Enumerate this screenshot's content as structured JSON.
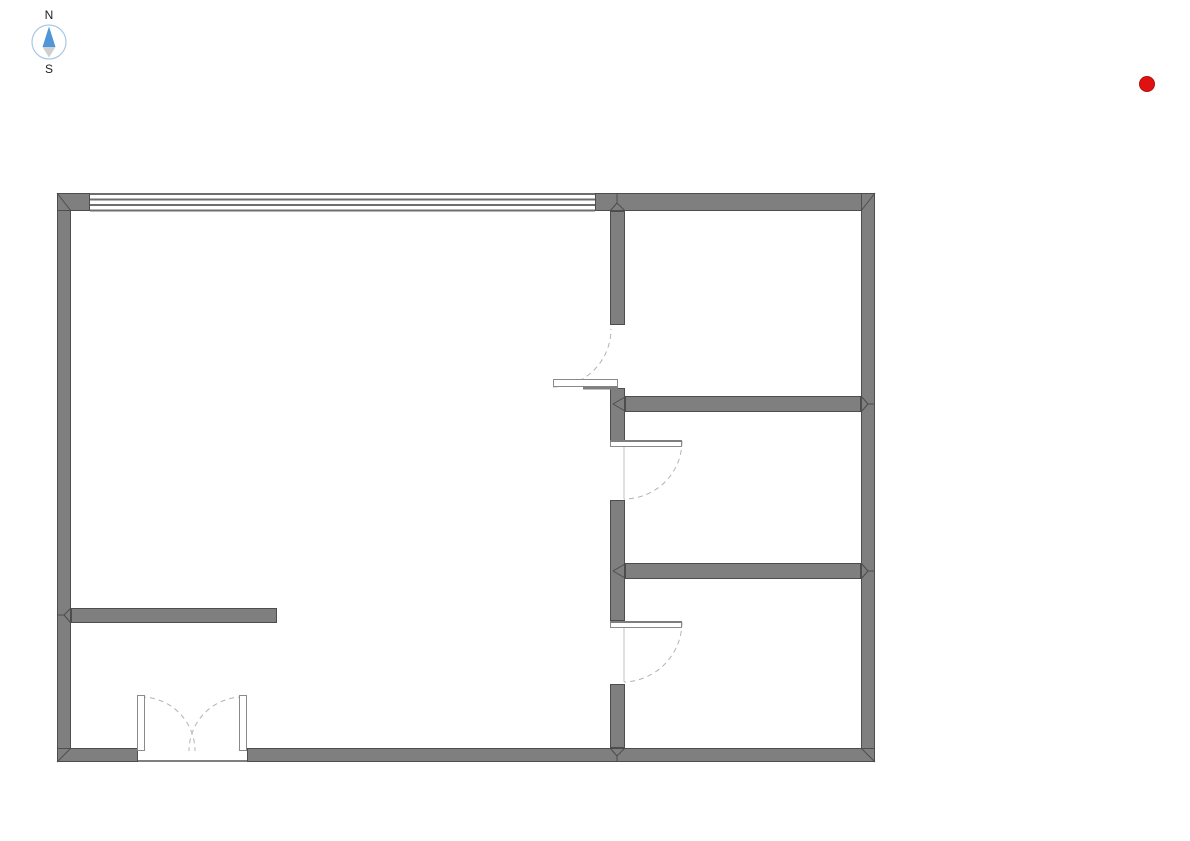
{
  "canvas": {
    "width": 1190,
    "height": 841,
    "background": "#ffffff"
  },
  "compass": {
    "north_label": "N",
    "south_label": "S",
    "circle_color": "#a9c7e5",
    "north_arrow_color": "#4f96d8",
    "south_arrow_color": "#cfcfcf",
    "label_color": "#1f1f1f"
  },
  "marker": {
    "color": "#e01111",
    "edge_color": "#b50d0d",
    "radius": 7.5
  },
  "floorplan": {
    "wall_fill": "#7f7f7f",
    "wall_stroke": "#4d4d4d",
    "window_line_color": "#6e6e6e",
    "arc_color": "#b3b3b3",
    "jamb_color": "#c2c2c2",
    "leaf_fill": "#ffffff",
    "leaf_stroke": "#8a8a8a",
    "leaf_edge_color": "#7f7f7f",
    "walls": [
      {
        "id": "wall-left",
        "x": 57,
        "y": 193,
        "w": 14,
        "h": 569
      },
      {
        "id": "wall-top-left-pier",
        "x": 57,
        "y": 193,
        "w": 33,
        "h": 18
      },
      {
        "id": "wall-top-right",
        "x": 595,
        "y": 193,
        "w": 280,
        "h": 18
      },
      {
        "id": "wall-right",
        "x": 861,
        "y": 193,
        "w": 14,
        "h": 569
      },
      {
        "id": "wall-bottom-left",
        "x": 57,
        "y": 748,
        "w": 81,
        "h": 14
      },
      {
        "id": "wall-bottom-right",
        "x": 247,
        "y": 748,
        "w": 628,
        "h": 14
      },
      {
        "id": "wall-interior-vert-1",
        "x": 610,
        "y": 211,
        "w": 15,
        "h": 114
      },
      {
        "id": "wall-interior-vert-2",
        "x": 610,
        "y": 388,
        "w": 15,
        "h": 53
      },
      {
        "id": "wall-interior-vert-3",
        "x": 610,
        "y": 500,
        "w": 15,
        "h": 121
      },
      {
        "id": "wall-interior-vert-4",
        "x": 610,
        "y": 684,
        "w": 15,
        "h": 64
      },
      {
        "id": "wall-interior-horiz-1",
        "x": 625,
        "y": 396,
        "w": 236,
        "h": 16
      },
      {
        "id": "wall-interior-horiz-2",
        "x": 625,
        "y": 563,
        "w": 236,
        "h": 16
      },
      {
        "id": "wall-interior-stub",
        "x": 71,
        "y": 608,
        "w": 206,
        "h": 15
      }
    ],
    "window": {
      "id": "window-top",
      "x1": 90,
      "x2": 595,
      "line_ys": [
        194,
        199.5,
        205,
        210.5
      ],
      "line_width": 2
    },
    "thresholds": [
      {
        "id": "double-door-threshold",
        "x1": 138,
        "y1": 761,
        "x2": 247,
        "y2": 761
      }
    ],
    "doors": [
      {
        "id": "door-1",
        "leaf": {
          "x": 553,
          "y": 379,
          "w": 65,
          "h": 8
        },
        "edge": {
          "x1": 583,
          "y1": 388,
          "x2": 618,
          "y2": 388,
          "w": 3
        },
        "arc": "M 553 387 A 58 58 0 0 0 611 329",
        "jamb": null
      },
      {
        "id": "door-2",
        "leaf": {
          "x": 610,
          "y": 440,
          "w": 72,
          "h": 7
        },
        "edge": {
          "x1": 610,
          "y1": 441,
          "x2": 682,
          "y2": 441,
          "w": 2
        },
        "arc": "M 682 441 A 58 58 0 0 1 624 499",
        "jamb": {
          "x1": 624,
          "y1": 447,
          "x2": 624,
          "y2": 499
        }
      },
      {
        "id": "door-3",
        "leaf": {
          "x": 610,
          "y": 621,
          "w": 72,
          "h": 7
        },
        "edge": {
          "x1": 610,
          "y1": 622,
          "x2": 682,
          "y2": 622,
          "w": 2
        },
        "arc": "M 682 622 A 60 60 0 0 1 624 682",
        "jamb": {
          "x1": 624,
          "y1": 628,
          "x2": 624,
          "y2": 682
        }
      },
      {
        "id": "double-door-left-leaf",
        "leaf": {
          "x": 137,
          "y": 695,
          "w": 8,
          "h": 56
        },
        "edge": null,
        "arc": "M 141 697 A 54 54 0 0 1 195 751",
        "jamb": null
      },
      {
        "id": "double-door-right-leaf",
        "leaf": {
          "x": 239,
          "y": 695,
          "w": 8,
          "h": 56
        },
        "edge": null,
        "arc": "M 243 697 A 54 54 0 0 0 189 751",
        "jamb": null
      }
    ],
    "miters": [
      {
        "x1": 57,
        "y1": 193,
        "x2": 71,
        "y2": 211
      },
      {
        "x1": 875,
        "y1": 193,
        "x2": 861,
        "y2": 211
      },
      {
        "x1": 57,
        "y1": 762,
        "x2": 71,
        "y2": 748
      },
      {
        "x1": 875,
        "y1": 762,
        "x2": 861,
        "y2": 748
      },
      {
        "x1": 610,
        "y1": 211,
        "x2": 617,
        "y2": 203
      },
      {
        "x1": 625,
        "y1": 211,
        "x2": 617,
        "y2": 203
      },
      {
        "x1": 617,
        "y1": 203,
        "x2": 617,
        "y2": 194
      },
      {
        "x1": 610,
        "y1": 748,
        "x2": 617,
        "y2": 756
      },
      {
        "x1": 625,
        "y1": 748,
        "x2": 617,
        "y2": 756
      },
      {
        "x1": 617,
        "y1": 756,
        "x2": 617,
        "y2": 761
      },
      {
        "x1": 71,
        "y1": 608,
        "x2": 64,
        "y2": 615
      },
      {
        "x1": 71,
        "y1": 623,
        "x2": 64,
        "y2": 615
      },
      {
        "x1": 64,
        "y1": 615,
        "x2": 58,
        "y2": 615
      },
      {
        "x1": 861,
        "y1": 396,
        "x2": 868,
        "y2": 404
      },
      {
        "x1": 861,
        "y1": 412,
        "x2": 868,
        "y2": 404
      },
      {
        "x1": 868,
        "y1": 404,
        "x2": 874,
        "y2": 404
      },
      {
        "x1": 861,
        "y1": 563,
        "x2": 868,
        "y2": 571
      },
      {
        "x1": 861,
        "y1": 579,
        "x2": 868,
        "y2": 571
      },
      {
        "x1": 868,
        "y1": 571,
        "x2": 874,
        "y2": 571
      },
      {
        "x1": 625,
        "y1": 397,
        "x2": 613,
        "y2": 404
      },
      {
        "x1": 625,
        "y1": 411,
        "x2": 613,
        "y2": 404
      },
      {
        "x1": 625,
        "y1": 564,
        "x2": 613,
        "y2": 571
      },
      {
        "x1": 625,
        "y1": 578,
        "x2": 613,
        "y2": 571
      }
    ]
  }
}
